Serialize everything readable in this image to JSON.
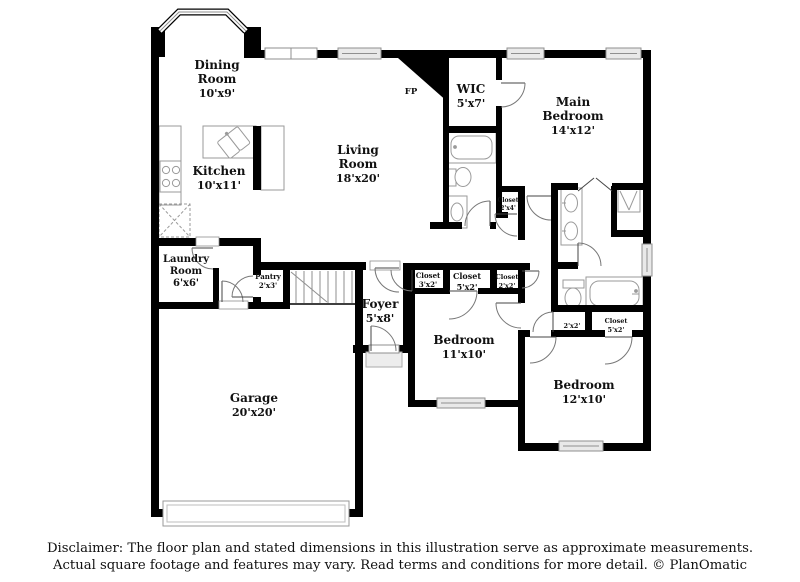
{
  "labels": {
    "dining": [
      "Dining",
      "Room",
      "10'x9'"
    ],
    "kitchen": [
      "Kitchen",
      "10'x11'"
    ],
    "living": [
      "Living",
      "Room",
      "18'x20'"
    ],
    "wic": [
      "WIC",
      "5'x7'"
    ],
    "main_bedroom": [
      "Main",
      "Bedroom",
      "14'x12'"
    ],
    "laundry": [
      "Laundry",
      "Room",
      "6'x6'"
    ],
    "pantry": [
      "Pantry",
      "2'x3'"
    ],
    "foyer": [
      "Foyer",
      "5'x8'"
    ],
    "garage": [
      "Garage",
      "20'x20'"
    ],
    "bedroom_11": [
      "Bedroom",
      "11'x10'"
    ],
    "bedroom_12": [
      "Bedroom",
      "12'x10'"
    ],
    "closet_3x2": [
      "Closet",
      "3'x2'"
    ],
    "closet_5x2_bed11": [
      "Closet",
      "5'x2'"
    ],
    "closet_2x2_bed11": [
      "Closet",
      "2'x2'"
    ],
    "closet_2x4": [
      "Closet",
      "2'x4'"
    ],
    "closet_2x2_bath": [
      "2'x2'"
    ],
    "closet_5x2_bath": [
      "Closet",
      "5'x2'"
    ],
    "fireplace": "FP"
  },
  "footer": {
    "line1": "Disclaimer: The floor plan and stated dimensions in this illustration serve as approximate measurements.",
    "line2": "Actual square footage and features may vary. Read terms and conditions for more detail. © PlanOmatic"
  },
  "colors": {
    "wall": "#000000",
    "background": "#ffffff",
    "window_stroke": "#8f8f8f",
    "fixture_stroke": "#9a9a9a",
    "door_stroke": "#777777",
    "door_leaf": "#444444",
    "porch_fill": "#ededed",
    "text": "#111111"
  }
}
